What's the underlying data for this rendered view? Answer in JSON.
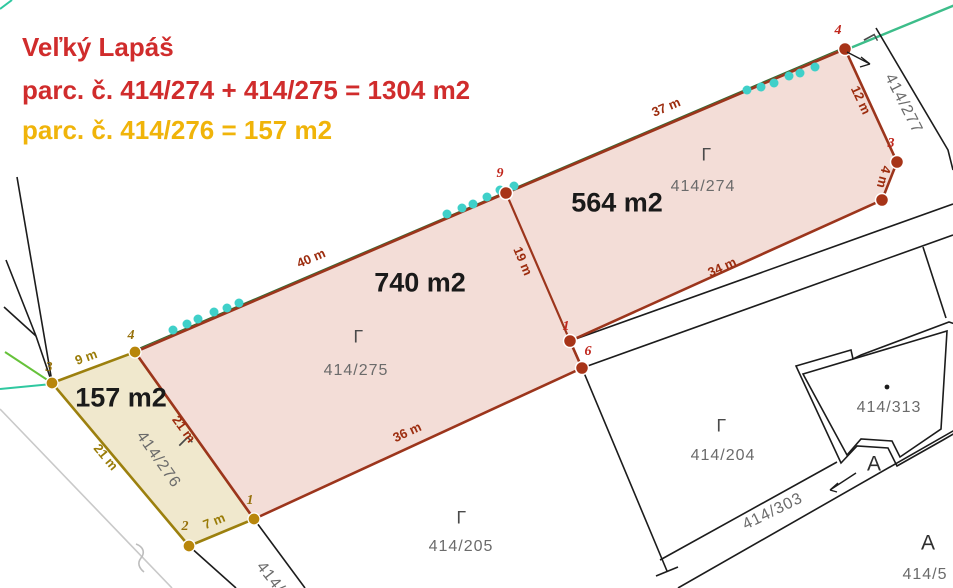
{
  "header": {
    "town": "Veľký Lapáš",
    "red_parcels_line": "parc. č. 414/274 + 414/275 = 1304 m2",
    "yellow_parcel_line": "parc. č. 414/276 = 157 m2"
  },
  "parcels": {
    "p274": {
      "number": "414/274",
      "area": "564 m2"
    },
    "p275": {
      "number": "414/275",
      "area": "740 m2"
    },
    "p276": {
      "number": "414/276",
      "area": "157 m2"
    },
    "p277": {
      "number": "414/277"
    },
    "p204": {
      "number": "414/204"
    },
    "p205": {
      "number": "414/205"
    },
    "p303": {
      "number": "414/303"
    },
    "p313": {
      "number": "414/313"
    },
    "p5": {
      "number": "414/5"
    },
    "p_edge_partial": {
      "number": "414/"
    }
  },
  "dimensions": {
    "top_275": "40 m",
    "top_274": "37 m",
    "right_upper": "12 m",
    "right_lower": "4 m",
    "divider": "19 m",
    "bottom_274": "34 m",
    "bottom_275": "36 m",
    "shared_edge": "21 m",
    "left_276": "21 m",
    "top_276": "9 m",
    "bottom_276": "7 m"
  },
  "points": {
    "red": [
      "4",
      "3",
      "9",
      "1",
      "6"
    ],
    "yellow": [
      "3",
      "4",
      "2",
      "1"
    ]
  },
  "symbols": {
    "land_use_mark": "Γ",
    "building_mark_1": "A",
    "building_mark_2": "A"
  },
  "colors": {
    "red_parcel_fill": "#f3ddd7",
    "red_parcel_border": "#9c351c",
    "yellow_parcel_fill": "#f0e8cd",
    "yellow_parcel_border": "#9c800e",
    "title_red": "#d02c2c",
    "title_yellow": "#f0b40a",
    "survey_point_red": "#a73418",
    "survey_point_yellow": "#b8860b",
    "tree_dot_teal": "#3fd0c9",
    "utility_line_green": "#3dbd8a",
    "boundary_black": "#1c1c1c",
    "parcel_number_gray": "#6b6b6b"
  }
}
